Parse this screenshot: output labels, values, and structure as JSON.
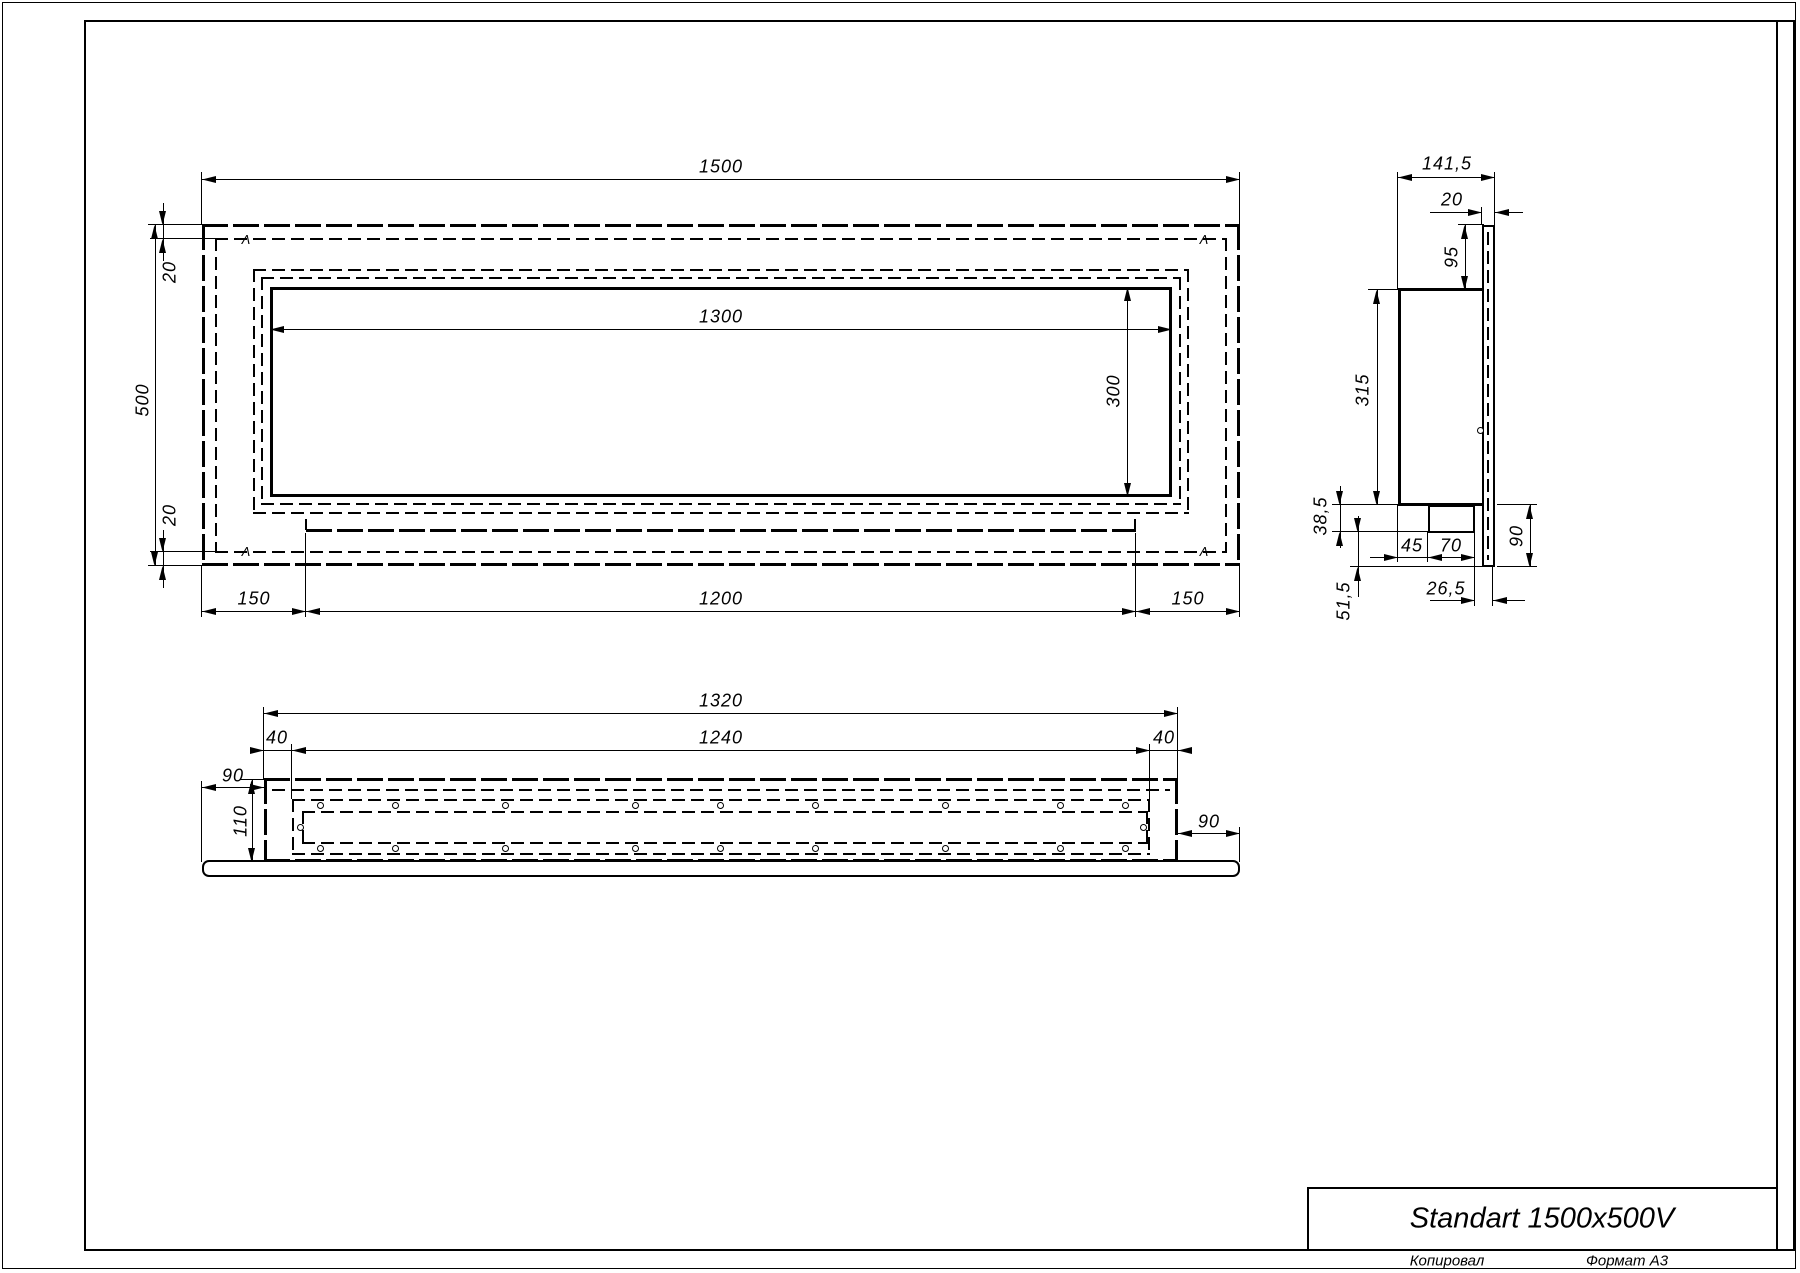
{
  "title_block": {
    "product_name": "Standart 1500x500V"
  },
  "footer": {
    "copied_by": "Копировал",
    "format": "Формат А3"
  },
  "front_view": {
    "width": "1500",
    "height": "500",
    "offset_top": "20",
    "offset_bottom": "20",
    "opening_width": "1300",
    "opening_height": "300",
    "margin_left": "150",
    "inner_width": "1200",
    "margin_right": "150",
    "corner_mark": "Λ"
  },
  "side_view": {
    "depth": "141,5",
    "panel_thickness": "20",
    "panel_top_height": "95",
    "body_height": "315",
    "tray_height": "38,5",
    "tray_offset": "45",
    "tray_width": "70",
    "panel_bottom_height": "90",
    "tray_to_front": "26,5",
    "bottom_height": "51,5"
  },
  "bottom_view": {
    "body_width": "1320",
    "inner_width": "1240",
    "inset_left": "40",
    "inset_right": "40",
    "overhang_left": "90",
    "overhang_right": "90",
    "depth": "110"
  }
}
